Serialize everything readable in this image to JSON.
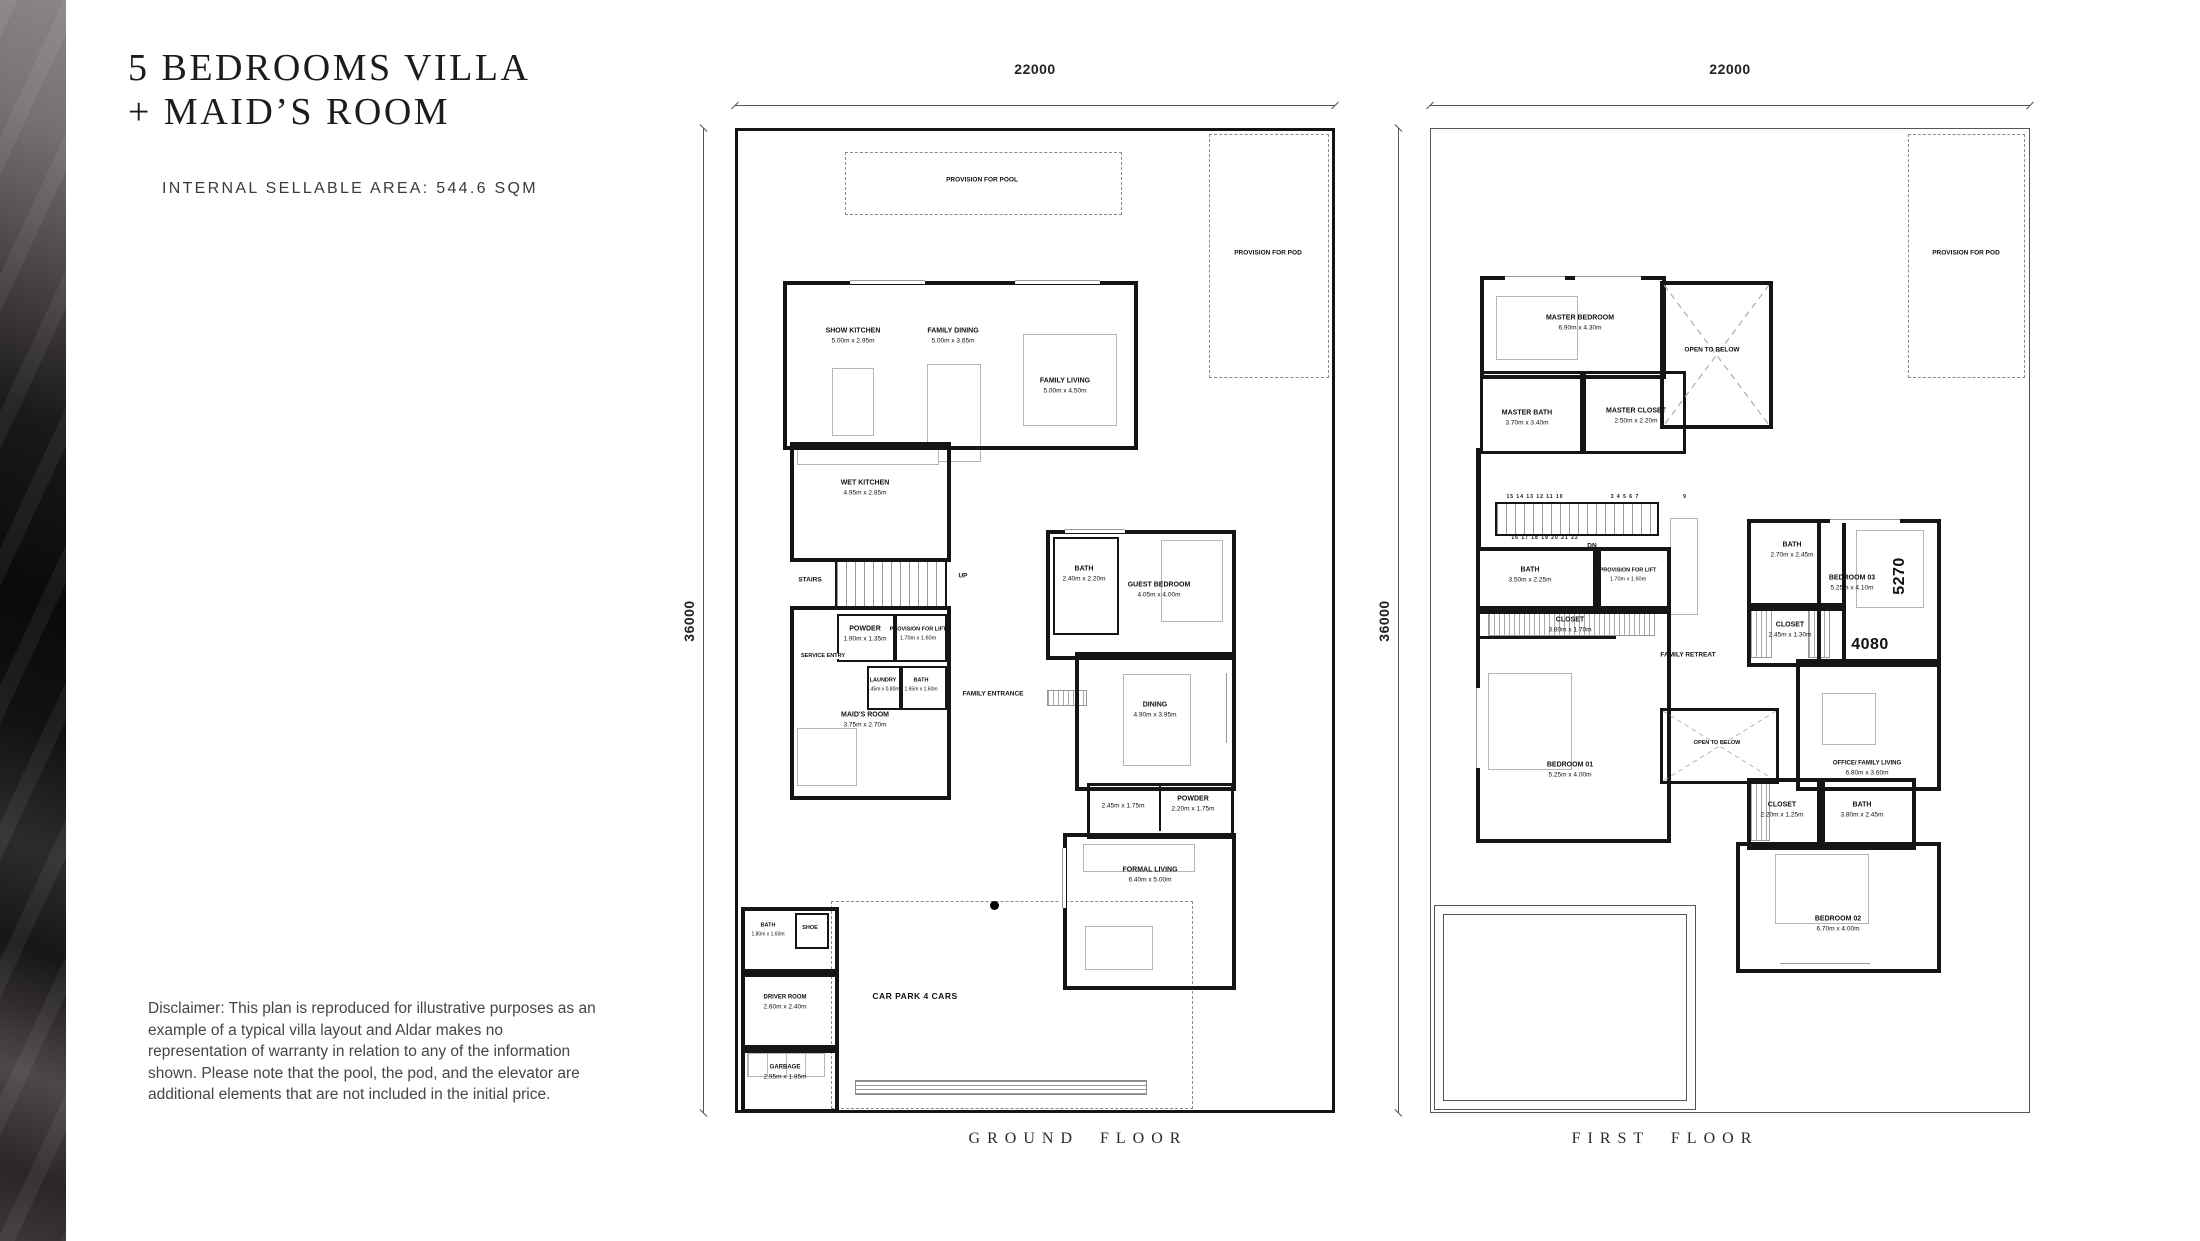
{
  "header": {
    "title_line1": "5 BEDROOMS VILLA",
    "title_line2": "+ MAID’S ROOM",
    "area_label": "INTERNAL SELLABLE AREA: 544.6 SQM"
  },
  "disclaimer": "Disclaimer: This plan is reproduced for illustrative purposes as an example of a typical villa layout and Aldar makes no representation of warranty in relation to any of the information shown. Please note that the pool, the pod, and the elevator are additional elements that are not included in the initial price.",
  "ground_floor": {
    "label": "GROUND FLOOR",
    "width_dim": "22000",
    "height_dim": "36000",
    "annotations": {
      "pool": "PROVISION FOR POOL",
      "pod": "PROVISION FOR POD",
      "stairs": "STAIRS",
      "up": "UP",
      "service_entry": "SERVICE ENTRY",
      "family_entrance": "FAMILY ENTRANCE",
      "car_park": "CAR PARK 4 CARS"
    },
    "rooms": {
      "show_kitchen": {
        "name": "SHOW KITCHEN",
        "size": "5.00m x 2.95m"
      },
      "family_dining": {
        "name": "FAMILY DINING",
        "size": "5.00m x 3.65m"
      },
      "family_living": {
        "name": "FAMILY LIVING",
        "size": "5.00m x 4.50m"
      },
      "wet_kitchen": {
        "name": "WET KITCHEN",
        "size": "4.95m x 2.85m"
      },
      "powder1": {
        "name": "POWDER",
        "size": "1.90m x 1.35m"
      },
      "lift": {
        "name": "PROVISION FOR LIFT",
        "size": "1.70m x 1.60m"
      },
      "laundry": {
        "name": "LAUNDRY",
        "size": "1.45m x 0.80m"
      },
      "bath1": {
        "name": "BATH",
        "size": "1.65m x 1.60m"
      },
      "maids_room": {
        "name": "MAID'S ROOM",
        "size": "3.75m x 2.70m"
      },
      "guest_bath": {
        "name": "BATH",
        "size": "2.40m x 2.20m"
      },
      "guest_bedroom": {
        "name": "GUEST BEDROOM",
        "size": "4.05m x 4.00m"
      },
      "dining": {
        "name": "DINING",
        "size": "4.90m x 3.95m"
      },
      "corridor": {
        "size": "2.45m x 1.75m"
      },
      "powder2": {
        "name": "POWDER",
        "size": "2.20m x 1.75m"
      },
      "formal_living": {
        "name": "FORMAL LIVING",
        "size": "6.40m x 5.00m"
      },
      "bath2": {
        "name": "BATH",
        "size": "1.80m x 1.60m"
      },
      "shoe": {
        "name": "SHOE"
      },
      "driver_room": {
        "name": "DRIVER ROOM",
        "size": "2.60m x 2.40m"
      },
      "garbage": {
        "name": "GARBAGE",
        "size": "2.95m x 1.85m"
      }
    }
  },
  "first_floor": {
    "label": "FIRST FLOOR",
    "width_dim": "22000",
    "height_dim": "36000",
    "annotations": {
      "pod": "PROVISION FOR POD",
      "open_below_top": "OPEN TO BELOW",
      "open_below_mid": "OPEN TO BELOW",
      "family_retreat": "FAMILY RETREAT",
      "dn": "DN",
      "stair_top": "15 14 13 12 11 10",
      "stair_mid": "3  4  5  6  7",
      "stair_nine": "9",
      "stair_bottom": "16 17 18 19 20 21 22",
      "big_5270": "5270",
      "big_4080": "4080"
    },
    "rooms": {
      "master_bedroom": {
        "name": "MASTER BEDROOM",
        "size": "6.90m x 4.30m"
      },
      "master_bath": {
        "name": "MASTER BATH",
        "size": "3.70m x 3.40m"
      },
      "master_closet": {
        "name": "MASTER CLOSET",
        "size": "2.50m x 2.20m"
      },
      "bath3": {
        "name": "BATH",
        "size": "3.50m x 2.25m"
      },
      "lift": {
        "name": "PROVISION FOR LIFT",
        "size": "1.70m x 1.60m"
      },
      "closet1": {
        "name": "CLOSET",
        "size": "3.80m x 1.70m"
      },
      "bedroom1": {
        "name": "BEDROOM 01",
        "size": "5.25m x 4.00m"
      },
      "bath4": {
        "name": "BATH",
        "size": "2.70m x 2.45m"
      },
      "closet2": {
        "name": "CLOSET",
        "size": "2.45m x 1.30m"
      },
      "bedroom3": {
        "name": "BEDROOM 03",
        "size": "5.25m x 4.10m"
      },
      "office": {
        "name": "OFFICE/ FAMILY LIVING",
        "size": "6.80m x 3.60m"
      },
      "closet3": {
        "name": "CLOSET",
        "size": "2.20m x 1.25m"
      },
      "bath5": {
        "name": "BATH",
        "size": "3.80m x 2.45m"
      },
      "bedroom2": {
        "name": "BEDROOM 02",
        "size": "6.70m x 4.00m"
      }
    }
  }
}
